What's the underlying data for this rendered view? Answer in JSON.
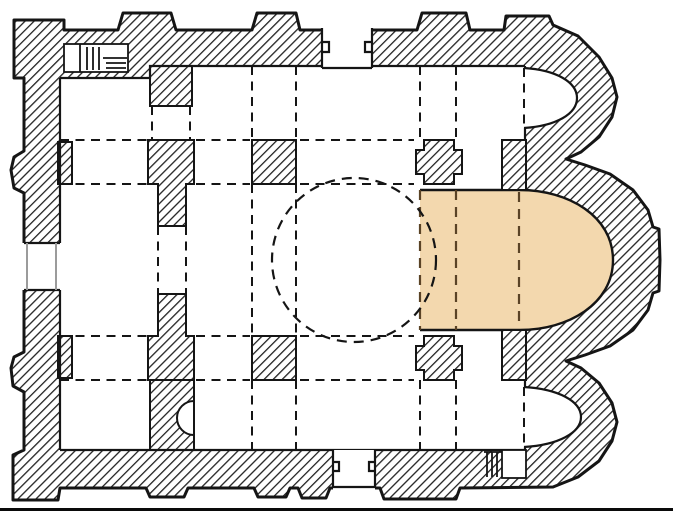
{
  "plan": {
    "description_label": "byzantine-church-ground-plan",
    "colors": {
      "background": "#ffffff",
      "wall_line": "#151515",
      "hatch_line": "#222222",
      "highlight": "#f3d8ae",
      "highlight_dash": "#5a4326",
      "door_jamb_grey": "#9b9b9b",
      "bottom_rule": "#0a0a0a"
    },
    "highlighted_area": "central-bema-and-apse",
    "parts": [
      "outer-hatched-walls",
      "narthex",
      "naos",
      "dome-circle",
      "north-apse",
      "central-apse",
      "south-apse",
      "crossing-piers",
      "west-door",
      "north-door",
      "south-door",
      "northwest-staircase",
      "southeast-staircase",
      "wall-niche"
    ]
  }
}
